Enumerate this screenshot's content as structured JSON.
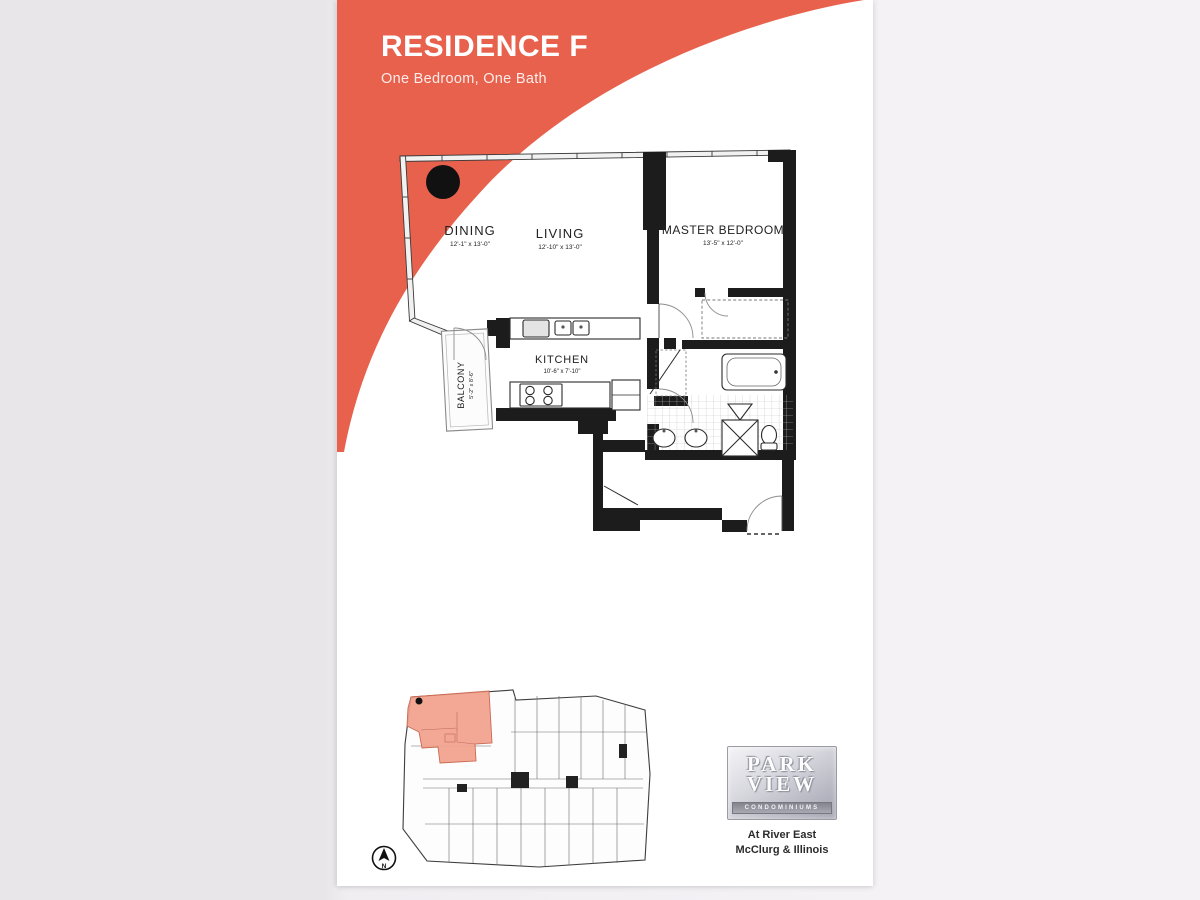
{
  "page": {
    "title": "RESIDENCE F",
    "subtitle": "One Bedroom, One Bath"
  },
  "floorplan": {
    "rooms": [
      {
        "name": "DINING",
        "dims": "12'-1\" x 13'-0\""
      },
      {
        "name": "LIVING",
        "dims": "12'-10\" x 13'-0\""
      },
      {
        "name": "MASTER BEDROOM",
        "dims": "13'-5\" x 12'-0\""
      },
      {
        "name": "KITCHEN",
        "dims": "10'-6\" x 7'-10\""
      },
      {
        "name": "BALCONY",
        "dims": "5'-2\" x 8'-6\""
      }
    ]
  },
  "keyplan": {
    "compass_label": "N"
  },
  "branding": {
    "logo_line1": "PARK",
    "logo_line2": "VIEW",
    "logo_line3": "CONDOMINIUMS",
    "address_line1": "At River East",
    "address_line2": "McClurg & Illinois"
  },
  "colors": {
    "accent": "#E7614D",
    "unit_highlight": "#F2A18D",
    "wall": "#1c1c1c"
  }
}
